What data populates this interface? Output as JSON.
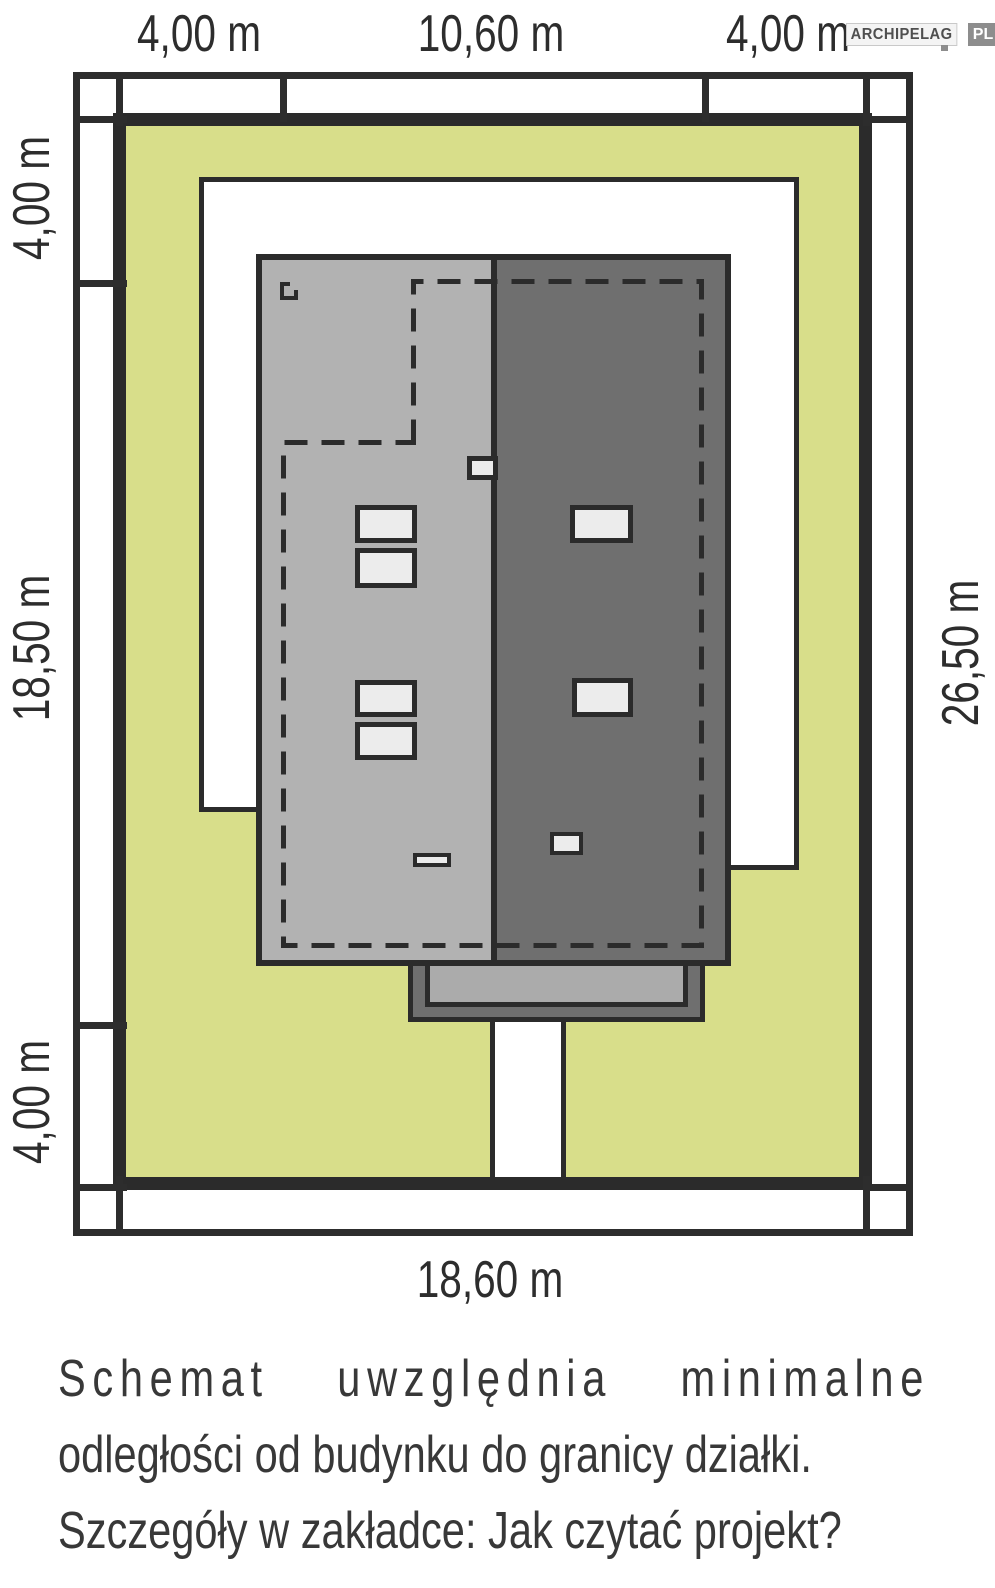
{
  "logo": {
    "brand": "ARCHIPELAG",
    "tld": "PL"
  },
  "dimensions": {
    "top": [
      "4,00 m",
      "10,60 m",
      "4,00 m"
    ],
    "left": [
      "4,00 m",
      "18,50 m",
      "4,00 m"
    ],
    "right": "26,50 m",
    "bottom": "18,60 m"
  },
  "caption": {
    "line1": "Schemat uwzględnia minimalne",
    "line2": "odległości od budynku do granicy działki.",
    "line3": "Szczegóły w zakładce: Jak czytać projekt?"
  },
  "colors": {
    "plot_green": "#d8de8a",
    "outline_dark": "#2b2b2b",
    "dimension_dark": "#2d2d2d",
    "roof_light_gray": "#b2b2b2",
    "roof_dark_gray": "#6f6f6f",
    "terrace_gray": "#ababab",
    "window_light": "#ececec",
    "logo_gray": "#8d8d8d"
  }
}
